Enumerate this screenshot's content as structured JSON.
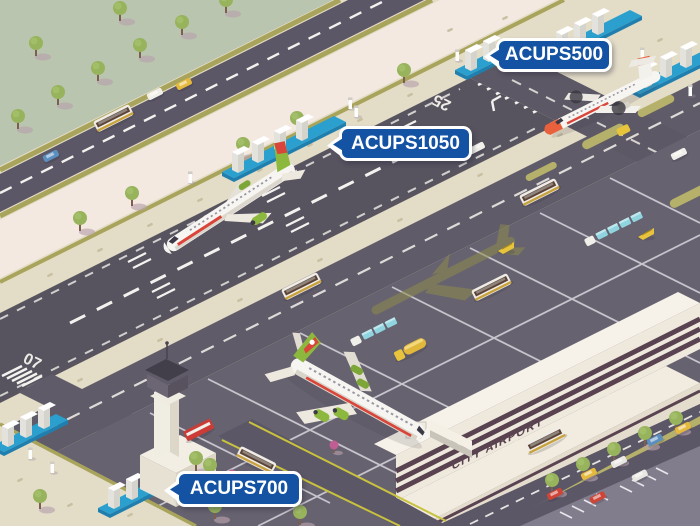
{
  "callouts": [
    {
      "label": "ACUPS500"
    },
    {
      "label": "ACUPS1050"
    },
    {
      "label": "ACUPS700"
    }
  ],
  "terminal": {
    "sign": "CITY AIRPORT"
  },
  "runway": {
    "number_left": "07",
    "number_right": "25"
  },
  "colors": {
    "callout_blue": "#1452a3",
    "grass": "#b9c5af",
    "ground_beige": "#e3dcc7",
    "pink_strip": "#f4e9e1",
    "road_gray": "#5c5766",
    "runway_gray": "#57535f",
    "apron_gray": "#67626f",
    "olive_edge": "#a9a45b",
    "platform_blue": "#2ba0cf",
    "building_cream": "#efe9dd",
    "window_maroon": "#5a4350",
    "plane_green": "#8cb83e",
    "plane_red": "#d9453a",
    "turboprop_orange": "#e8603c",
    "tree_green": "#97b35c"
  }
}
